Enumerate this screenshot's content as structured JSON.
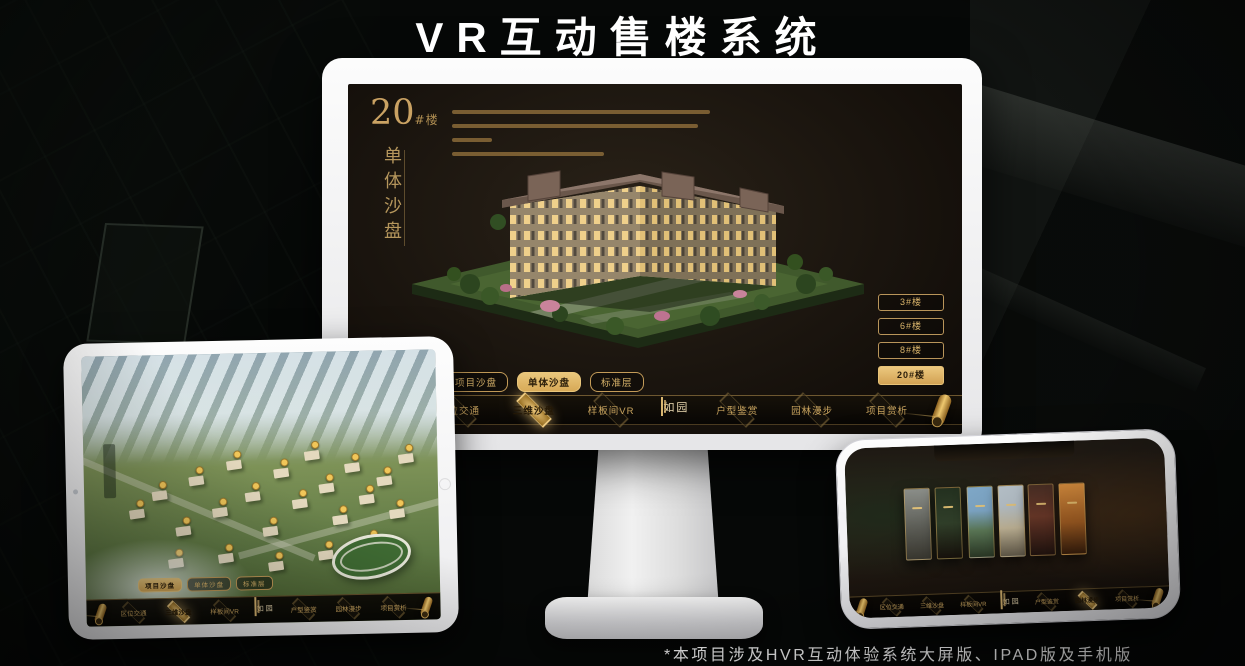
{
  "page": {
    "title": "VR互动售楼系统",
    "footnote": "*本项目涉及HVR互动体验系统大屏版、IPAD版及手机版"
  },
  "colors": {
    "gold": "#d8b36a",
    "gold_active": "#e3b966",
    "screen_bg": "#171210",
    "frame_white": "#f7f7f7"
  },
  "desktop": {
    "building_title": {
      "number": "20",
      "suffix": "#楼",
      "subtitle_vertical": "单体沙盘"
    },
    "floor_buttons": [
      {
        "label": "3#楼",
        "active": false
      },
      {
        "label": "6#楼",
        "active": false
      },
      {
        "label": "8#楼",
        "active": false
      },
      {
        "label": "20#楼",
        "active": true
      }
    ],
    "sub_tabs": [
      {
        "label": "项目沙盘",
        "active": false
      },
      {
        "label": "单体沙盘",
        "active": true
      },
      {
        "label": "标准层",
        "active": false
      }
    ],
    "nav": {
      "logo": "如园",
      "items": [
        {
          "label": "区位交通",
          "active": false
        },
        {
          "label": "三维沙盘",
          "active": true
        },
        {
          "label": "样板间VR",
          "active": false
        },
        {
          "label": "户型鉴赏",
          "active": false
        },
        {
          "label": "园林漫步",
          "active": false
        },
        {
          "label": "项目赏析",
          "active": false
        }
      ]
    }
  },
  "tablet": {
    "sub_tabs": [
      {
        "label": "项目沙盘",
        "active": true
      },
      {
        "label": "单体沙盘",
        "active": false
      },
      {
        "label": "标准层",
        "active": false
      }
    ],
    "nav": {
      "logo": "如园",
      "items": [
        {
          "label": "区位交通",
          "active": false
        },
        {
          "label": "三维沙盘",
          "active": true
        },
        {
          "label": "样板间VR",
          "active": false
        },
        {
          "label": "户型鉴赏",
          "active": false
        },
        {
          "label": "园林漫步",
          "active": false
        },
        {
          "label": "项目赏析",
          "active": false
        }
      ]
    }
  },
  "phone": {
    "nav": {
      "logo": "如园",
      "items": [
        {
          "label": "区位交通",
          "active": false
        },
        {
          "label": "三维沙盘",
          "active": false
        },
        {
          "label": "样板间VR",
          "active": false
        },
        {
          "label": "户型鉴赏",
          "active": false
        },
        {
          "label": "园林漫步",
          "active": true
        },
        {
          "label": "项目赏析",
          "active": false
        }
      ]
    }
  }
}
